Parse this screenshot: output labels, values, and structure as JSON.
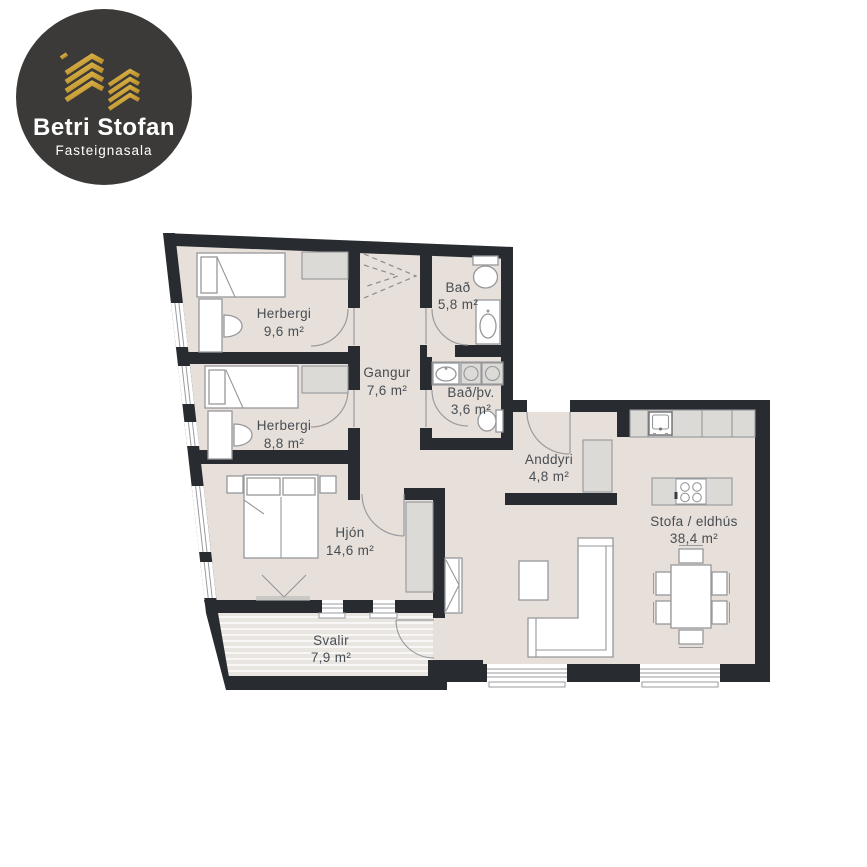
{
  "logo": {
    "title": "Betri Stofan",
    "subtitle": "Fasteignasala",
    "icon": "gold-buildings-chevrons"
  },
  "floorplan": {
    "type": "apartment-floor-plan",
    "total_rooms": 9,
    "rooms": [
      {
        "name": "Herbergi",
        "area": "9,6 m²"
      },
      {
        "name": "Herbergi",
        "area": "8,8 m²"
      },
      {
        "name": "Bað",
        "area": "5,8 m²"
      },
      {
        "name": "Gangur",
        "area": "7,6 m²"
      },
      {
        "name": "Bað/þv.",
        "area": "3,6 m²"
      },
      {
        "name": "Anddyri",
        "area": "4,8 m²"
      },
      {
        "name": "Stofa / eldhús",
        "area": "38,4 m²"
      },
      {
        "name": "Hjón",
        "area": "14,6 m²"
      },
      {
        "name": "Svalir",
        "area": "7,9 m²"
      }
    ]
  },
  "colors": {
    "wall": "#282b30",
    "floor": "#e7e0da",
    "deck": "#e9e5e1",
    "furniture_gray": "#dbdad6",
    "outline_gray": "#96979b",
    "label_text": "#474d53",
    "logo_background": "#3b3a39",
    "logo_gold": "#c59a33"
  }
}
